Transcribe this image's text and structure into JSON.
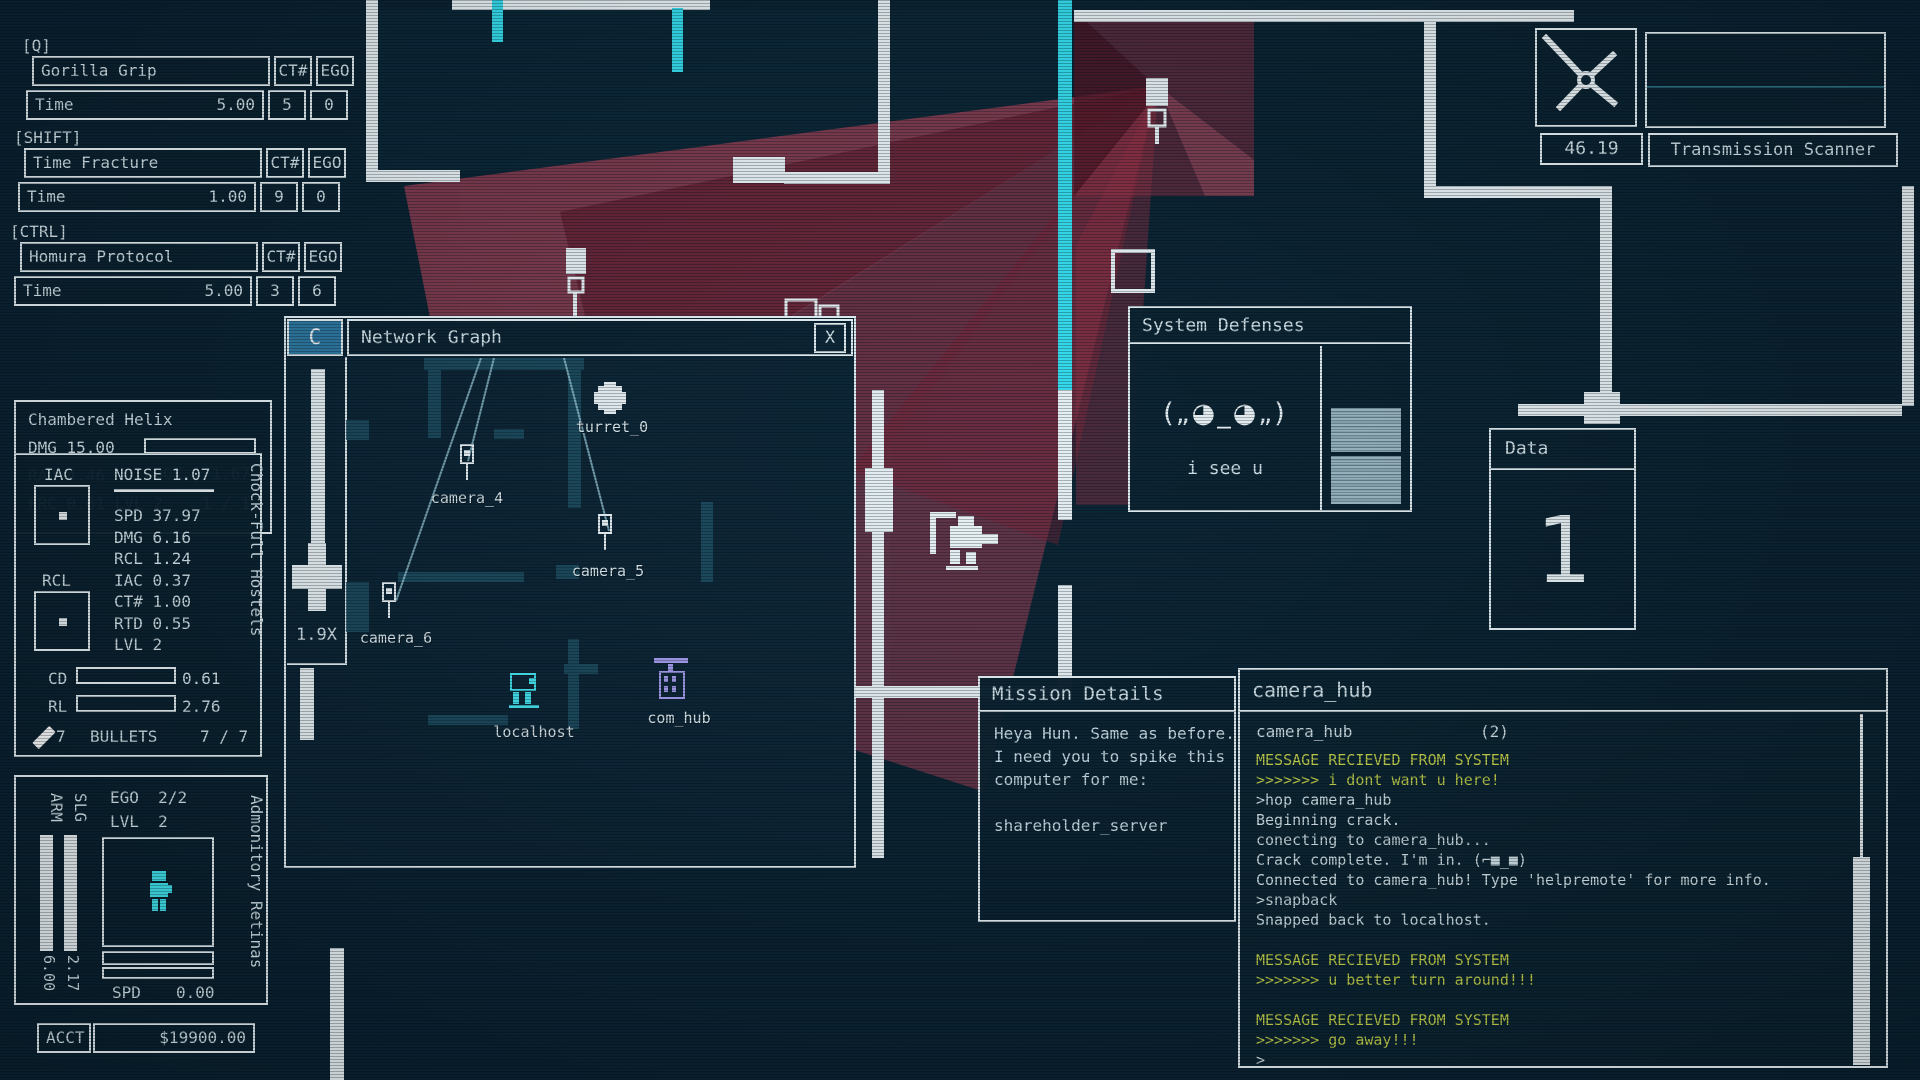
{
  "colors": {
    "accent_cyan": "#35dff0",
    "alert_red": "#a63e54",
    "terminal_yellow": "#c8d54a",
    "panel_border": "#e9f3f7",
    "panel_bg": "#0b2231",
    "text": "#d9e8ee",
    "localhost_cyan": "#46e6f1",
    "com_hub_purple": "#a79df0"
  },
  "abilities": [
    {
      "key_label": "[Q]",
      "name": "Gorilla Grip",
      "ct_header": "CT#",
      "ego_header": "EGO",
      "stat_label": "Time",
      "stat_value": "5.00",
      "ct_value": "5",
      "ego_value": "0"
    },
    {
      "key_label": "[SHIFT]",
      "name": "Time Fracture",
      "ct_header": "CT#",
      "ego_header": "EGO",
      "stat_label": "Time",
      "stat_value": "1.00",
      "ct_value": "9",
      "ego_value": "0"
    },
    {
      "key_label": "[CTRL]",
      "name": "Homura Protocol",
      "ct_header": "CT#",
      "ego_header": "EGO",
      "stat_label": "Time",
      "stat_value": "5.00",
      "ct_value": "3",
      "ego_value": "6"
    }
  ],
  "grenade_panel": {
    "title": "Chambered Helix",
    "dmg_label": "DMG 15.00",
    "rad_label": "RAD 4.46",
    "cook_label": "COOK | 1.67",
    "frc_label": "FRC 0.61 LVL 2",
    "count": "1 / 1"
  },
  "weapon_panel": {
    "iac_label": "IAC",
    "rcl_label": "RCL",
    "noise_label": "NOISE 1.07",
    "stats": [
      "SPD 37.97",
      "DMG 6.16",
      "RCL 1.24",
      "IAC 0.37",
      "CT# 1.00",
      "RTD 0.55",
      "LVL 2"
    ],
    "cd_label": "CD",
    "cd_value": "0.61",
    "rl_label": "RL",
    "rl_value": "2.76",
    "ammo_count": "7",
    "bullets_label": "BULLETS",
    "ammo_ratio": "7 / 7",
    "weapon_name_vertical": "Chock-Full Hostels"
  },
  "character_panel": {
    "ego_label": "EGO",
    "ego_value": "2/2",
    "lvl_label": "LVL",
    "lvl_value": "2",
    "arm_label": "ARM",
    "slg_label": "SLG",
    "arm_value": "6.00",
    "slg_value": "2.17",
    "spd_label": "SPD",
    "spd_value": "0.00",
    "augment_name_vertical": "Admonitory Retinas"
  },
  "account": {
    "label": "ACCT",
    "value": "$19900.00"
  },
  "network_graph": {
    "collapse_button": "C",
    "title": "Network Graph",
    "close_button": "X",
    "zoom_level": "1.9X",
    "nodes": [
      {
        "id": "turret_0",
        "label": "turret_0",
        "type": "turret"
      },
      {
        "id": "camera_4",
        "label": "camera_4",
        "type": "camera"
      },
      {
        "id": "camera_5",
        "label": "camera_5",
        "type": "camera"
      },
      {
        "id": "camera_6",
        "label": "camera_6",
        "type": "camera"
      },
      {
        "id": "localhost",
        "label": "localhost",
        "type": "localhost"
      },
      {
        "id": "com_hub",
        "label": "com_hub",
        "type": "com_hub"
      }
    ]
  },
  "system_defenses": {
    "title": "System Defenses",
    "emoticon": "(„◕_◕„)",
    "message": "i see u"
  },
  "data_panel": {
    "title": "Data",
    "value": "1"
  },
  "scanner": {
    "time_value": "46.19",
    "label": "Transmission Scanner"
  },
  "mission_details": {
    "title": "Mission Details",
    "body_lines": [
      "Heya Hun. Same as before.",
      "I need you to spike this",
      "computer for me:",
      "",
      "shareholder_server"
    ]
  },
  "terminal": {
    "title": "camera_hub",
    "tab_label": "camera_hub",
    "tab_count": "(2)",
    "lines": [
      {
        "text": "MESSAGE RECIEVED FROM SYSTEM",
        "style": "system"
      },
      {
        "text": ">>>>>>> i dont want u here!",
        "style": "system"
      },
      {
        "text": ">hop camera_hub",
        "style": "normal"
      },
      {
        "text": "Beginning crack.",
        "style": "normal"
      },
      {
        "text": "conecting to camera_hub...",
        "style": "normal"
      },
      {
        "text": "Crack complete. I'm in. (⌐■_■)",
        "style": "normal"
      },
      {
        "text": "Connected to camera_hub! Type 'helpremote' for more info.",
        "style": "normal"
      },
      {
        "text": ">snapback",
        "style": "normal"
      },
      {
        "text": "Snapped back to localhost.",
        "style": "normal"
      },
      {
        "text": "",
        "style": "normal"
      },
      {
        "text": "MESSAGE RECIEVED FROM SYSTEM",
        "style": "system"
      },
      {
        "text": ">>>>>>> u better turn around!!!",
        "style": "system"
      },
      {
        "text": "",
        "style": "normal"
      },
      {
        "text": "MESSAGE RECIEVED FROM SYSTEM",
        "style": "system"
      },
      {
        "text": ">>>>>>> go away!!!",
        "style": "system"
      },
      {
        "text": ">",
        "style": "normal"
      }
    ]
  }
}
